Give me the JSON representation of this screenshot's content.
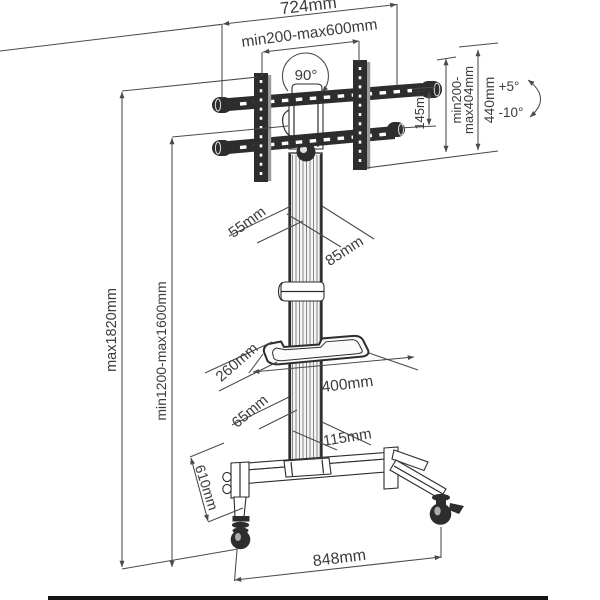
{
  "diagram": {
    "name": "mobile-tv-stand-dimension-diagram",
    "line_color": "#2d2d2d",
    "dim_color": "#4a4a4a",
    "text_color": "#3c3c3c",
    "labels": {
      "overall_width": "724mm",
      "vesa_width_range": "min200-max600mm",
      "swivel_angle": "90°",
      "rail_spacing": "145mm",
      "vesa_height_range_line1": "min200-",
      "vesa_height_range_line2": "max404mm",
      "bracket_height": "440mm",
      "tilt_up": "+5°",
      "tilt_down": "-10°",
      "column_depth": "55mm",
      "column_width": "85mm",
      "overall_height_max": "max1820mm",
      "screen_height_range": "min1200-max1600mm",
      "shelf_depth": "260mm",
      "shelf_width": "400mm",
      "column_base_depth": "65mm",
      "column_base_width": "115mm",
      "leg_depth": "610mm",
      "base_width": "848mm"
    }
  }
}
